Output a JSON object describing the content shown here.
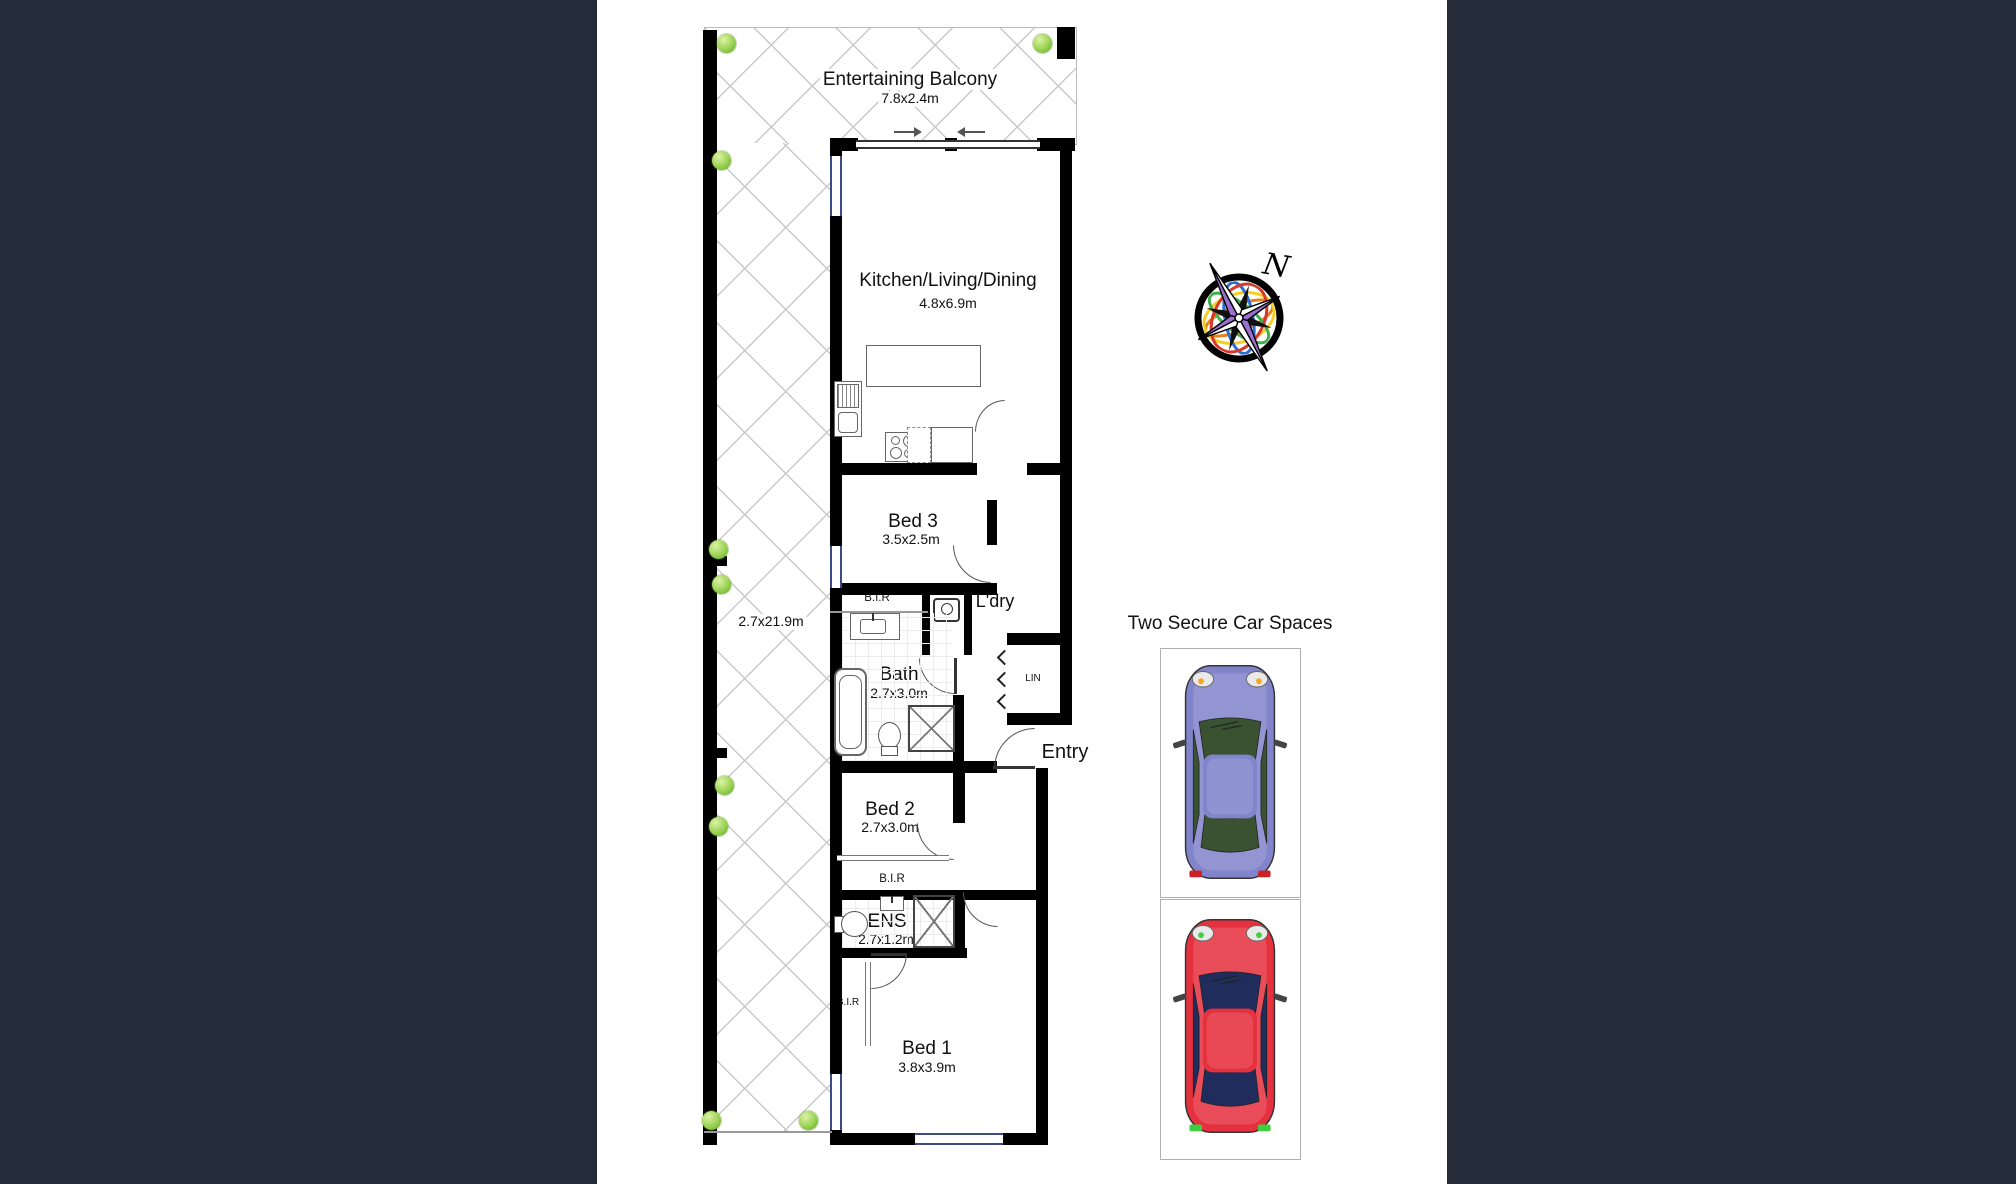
{
  "colors": {
    "page_background": "#242c39",
    "canvas_background": "#ffffff",
    "wall": "#000000",
    "lattice_line": "#c9c9c9",
    "shrub_green": "#8fd14f"
  },
  "plan": {
    "balcony": {
      "name": "Entertaining Balcony",
      "dims": "7.8x2.4m"
    },
    "terrace": {
      "dims": "2.7x21.9m"
    },
    "living": {
      "name": "Kitchen/Living/Dining",
      "dims": "4.8x6.9m"
    },
    "bed3": {
      "name": "Bed 3",
      "dims": "3.5x2.5m"
    },
    "bir_bed3": {
      "label": "B.I.R"
    },
    "laundry": {
      "label": "L'dry"
    },
    "bath": {
      "name": "Bath",
      "dims": "2.7x3.0m"
    },
    "linen": {
      "label": "LIN"
    },
    "entry": {
      "label": "Entry"
    },
    "bed2": {
      "name": "Bed 2",
      "dims": "2.7x3.0m"
    },
    "bir_bed2": {
      "label": "B.I.R"
    },
    "ens": {
      "name": "ENS",
      "dims": "2.7x1.2m"
    },
    "bir_bed1": {
      "label": "B.I.R"
    },
    "bed1": {
      "name": "Bed 1",
      "dims": "3.8x3.9m"
    },
    "fridge": {
      "label": "F"
    }
  },
  "compass": {
    "north_label": "N"
  },
  "car_spaces": {
    "title": "Two Secure Car Spaces",
    "cars": [
      {
        "name": "purple-car",
        "body_color": "#8184cb",
        "window_color": "#3a5232"
      },
      {
        "name": "red-car",
        "body_color": "#e5303e",
        "window_color": "#202c5c"
      }
    ]
  }
}
